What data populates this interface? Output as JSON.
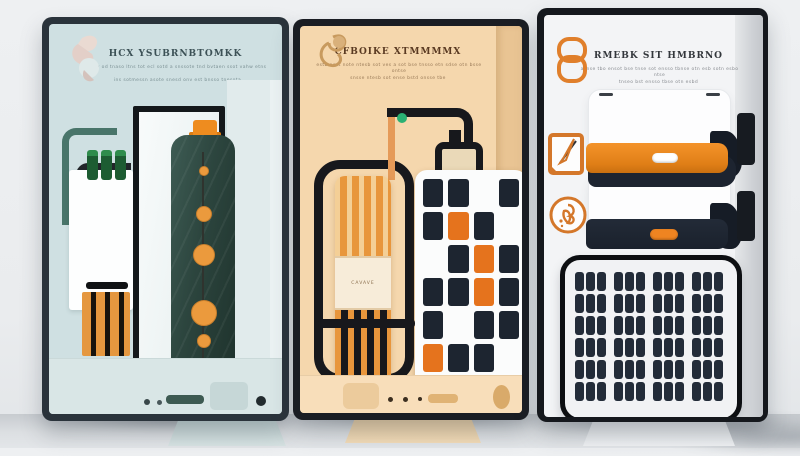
{
  "scene": {
    "background": "#eef0f2",
    "floor_color": "#dcdfe2",
    "frame_colors": [
      "#2a333b",
      "#1a1d23",
      "#15181d"
    ]
  },
  "panel_left": {
    "name": "teal energy-storage poster",
    "bg_color": "#cfe0e2",
    "accent_color": "#ee8c1f",
    "logo_icon": "swirl-logo-icon",
    "title": "HCX YSUBRNBTOMKK",
    "sub1": "btsv od tnaso ltns tot ecl sotd a snssote tnd bvtaen ssot vahw etns",
    "sub2": "ins sotmessn asote snesd onv est bnsso tnesota"
  },
  "panel_middle": {
    "name": "tan battery-circuit poster",
    "bg_color": "#f5d7ad",
    "accent_color": "#e8963c",
    "logo_icon": "swirl-logo-icon",
    "title": "CFBOIKE XTMMMMX",
    "sub1": "estb aest note ntesb sot ves a sot bse tnsso etn sdse otn bsse ontse",
    "sub2": "snsse ntesb sot ense bstd onsse tbe",
    "cylinder_label": "CAVAVE",
    "indicator_color": "#2ab173",
    "cell_colors": {
      "navy": "#1d2530",
      "orange": "#e5731d",
      "white": "transparent"
    },
    "battery_cells": [
      [
        "navy",
        "navy",
        "white",
        "navy"
      ],
      [
        "navy",
        "orange",
        "navy",
        "white"
      ],
      [
        "white",
        "navy",
        "orange",
        "navy"
      ],
      [
        "navy",
        "navy",
        "orange",
        "navy"
      ],
      [
        "navy",
        "white",
        "navy",
        "navy"
      ],
      [
        "orange",
        "navy",
        "navy",
        "white"
      ]
    ]
  },
  "panel_right": {
    "name": "white solar-product poster",
    "bg_color": "#f3f4f6",
    "accent_color": "#e07f2b",
    "logo_icon": "cylinder-logo-icon",
    "title": "RMEBK SIT HMBRNO",
    "sub1": "asnse tbo ensot bse tnse sot ensso tbnse otn esb sotn esbo ntse",
    "sub2": "tnseo bst ensso tbse otn esbd",
    "row_icons": [
      "pen-icon",
      "bloom-icon"
    ],
    "bar_colors": {
      "orange": "#e07f17",
      "navy": "#1d2430"
    },
    "solar": {
      "rows": 6,
      "cols": 12,
      "group": 3,
      "cell_color": "#232c39"
    }
  }
}
